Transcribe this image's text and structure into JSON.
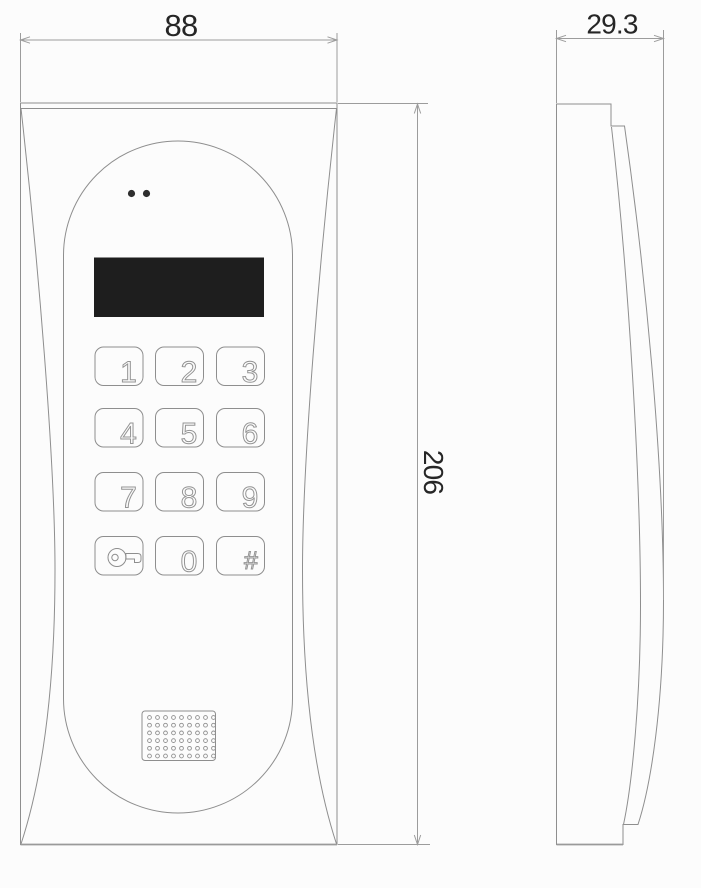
{
  "dimensions": {
    "width_label": "88",
    "depth_label": "29.3",
    "height_label": "206"
  },
  "keypad": {
    "keys": [
      {
        "label": "1"
      },
      {
        "label": "2"
      },
      {
        "label": "3"
      },
      {
        "label": "4"
      },
      {
        "label": "5"
      },
      {
        "label": "6"
      },
      {
        "label": "7"
      },
      {
        "label": "8"
      },
      {
        "label": "9"
      },
      {
        "label": "",
        "icon": "key-icon"
      },
      {
        "label": "0"
      },
      {
        "label": "#"
      }
    ]
  },
  "front_view": {
    "led_count": 2,
    "speaker_grille": {
      "rows": 6,
      "cols": 9
    }
  },
  "colors": {
    "line": "#8e8e8e",
    "light_line": "#9c9c9c",
    "display_fill": "#1e1e1e",
    "dim_text": "#262626",
    "background": "#fcfcfc"
  }
}
